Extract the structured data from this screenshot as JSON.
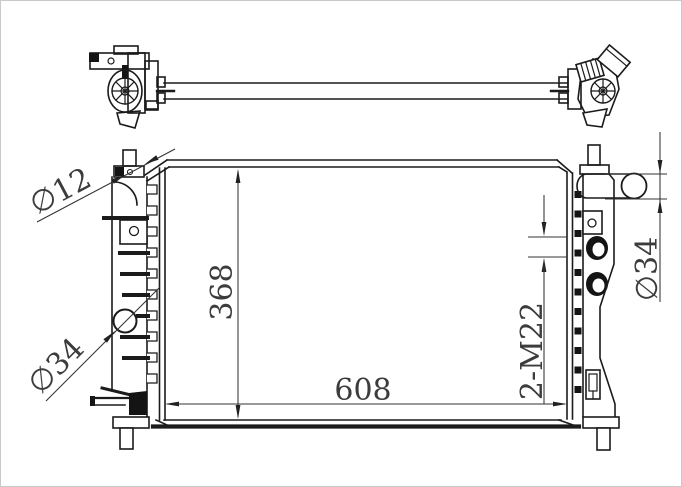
{
  "drawing": {
    "kind": "radiator-technical-drawing",
    "labels": {
      "pin_diameter": "∅12",
      "left_port_diameter": "∅34",
      "core_height": "368",
      "core_width": "608",
      "thread_ports": "2-M22",
      "inlet_diameter": "∅34"
    },
    "colors": {
      "outline": "#1b1b1b",
      "dimension_line": "#333333",
      "dimension_text": "#3c3c3c",
      "background": "#ffffff",
      "fill_dark": "#141414"
    }
  }
}
